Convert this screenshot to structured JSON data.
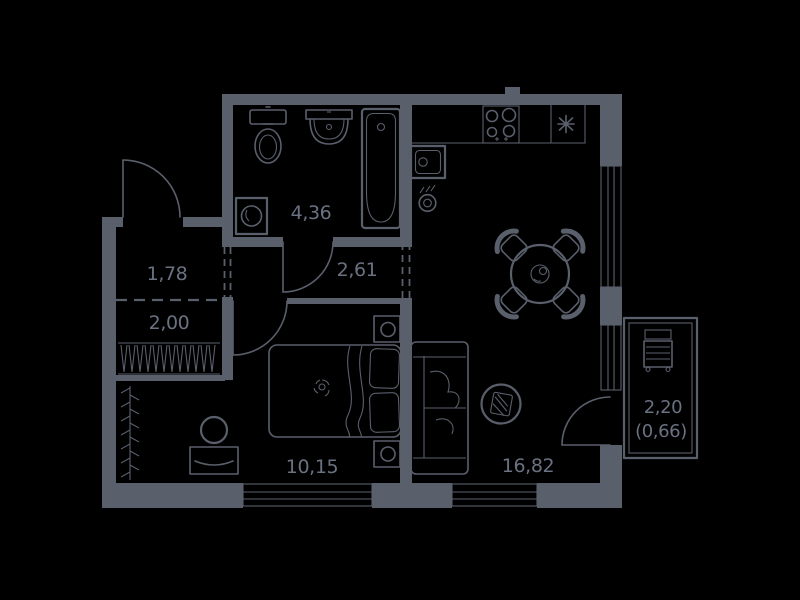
{
  "plan": {
    "type": "apartment-floor-plan",
    "background_color": "#000000",
    "line_color": "#5a5f6c",
    "text_color": "#6a7181",
    "rooms": [
      {
        "name": "hallway",
        "area": "1,78"
      },
      {
        "name": "closet",
        "area": "2,00"
      },
      {
        "name": "bathroom",
        "area": "4,36"
      },
      {
        "name": "corridor",
        "area": "2,61"
      },
      {
        "name": "bedroom",
        "area": "10,15"
      },
      {
        "name": "kitchen-living-room",
        "area": "16,82"
      },
      {
        "name": "balcony",
        "area": "2,20",
        "area_reduced": "(0,66)"
      }
    ],
    "symbols": [
      "toilet",
      "wash-basin",
      "bathtub",
      "washing-machine",
      "hob-stove",
      "refrigerator-snowflake",
      "kitchen-sink",
      "towel-dryer",
      "dining-table",
      "chair",
      "sofa",
      "electrical-panel",
      "double-bed",
      "nightstand",
      "dresser-with-mirror",
      "coat-rack",
      "wardrobe-shelves",
      "balcony-cabinet",
      "window",
      "door-swing"
    ]
  }
}
